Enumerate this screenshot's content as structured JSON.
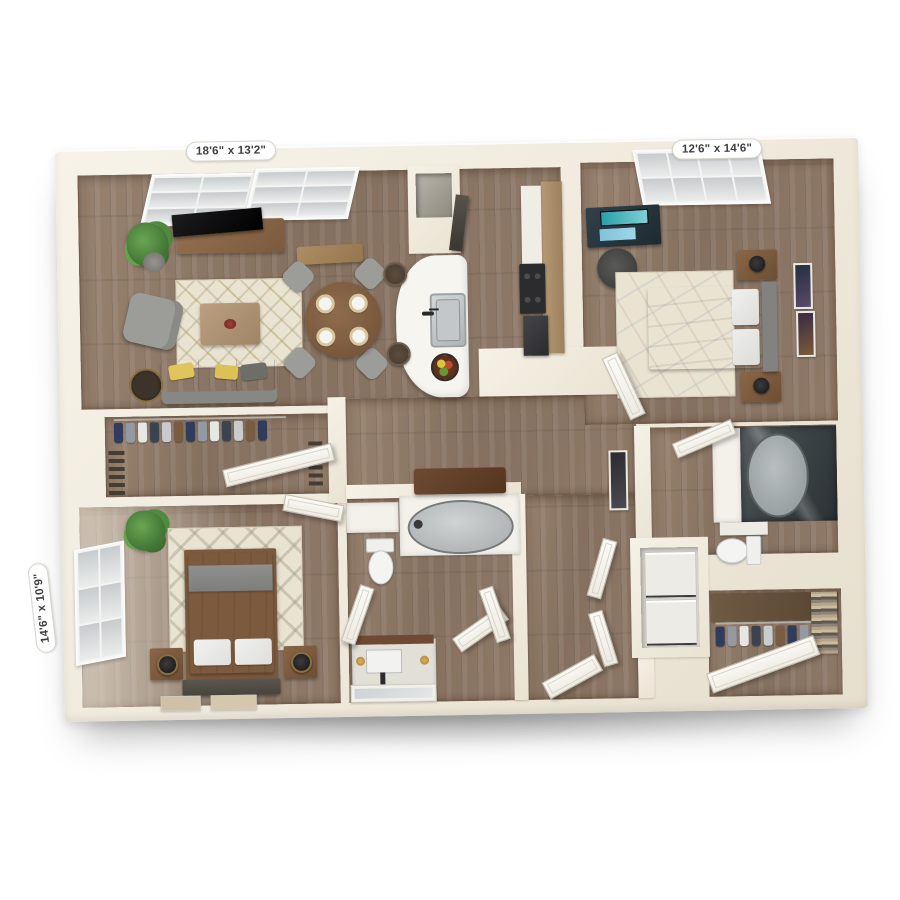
{
  "scene": {
    "type": "3d-floor-plan-render",
    "background_color": "#ffffff"
  },
  "dimension_labels": {
    "living_room": "18'6\" x 13'2\"",
    "bedroom_right": "12'6\" x 14'6\"",
    "bedroom_left": "14'6\" x 10'9\""
  },
  "rooms": [
    {
      "name": "living-dining-room",
      "dimensions": "18'6\" x 13'2\""
    },
    {
      "name": "bedroom-right",
      "dimensions": "12'6\" x 14'6\""
    },
    {
      "name": "bedroom-left",
      "dimensions": "14'6\" x 10'9\""
    },
    {
      "name": "kitchen"
    },
    {
      "name": "hallway"
    },
    {
      "name": "bathroom-center"
    },
    {
      "name": "bathroom-right"
    },
    {
      "name": "walk-in-closet-left"
    },
    {
      "name": "walk-in-closet-right"
    },
    {
      "name": "laundry-closet"
    },
    {
      "name": "entry"
    }
  ],
  "palette": {
    "wall": "#f0ead d-cream",
    "wall_cream": "#f0eadd",
    "wood_floor": "#8b7565",
    "rug_cream": "#e9e3d2",
    "sofa_gray": "#9b9b98",
    "accent_yellow": "#dfc45c",
    "furniture_wood": "#7b5b3e",
    "appliance_dark": "#333336",
    "label_text": "#3e3e3e",
    "label_background": "#ffffff"
  }
}
